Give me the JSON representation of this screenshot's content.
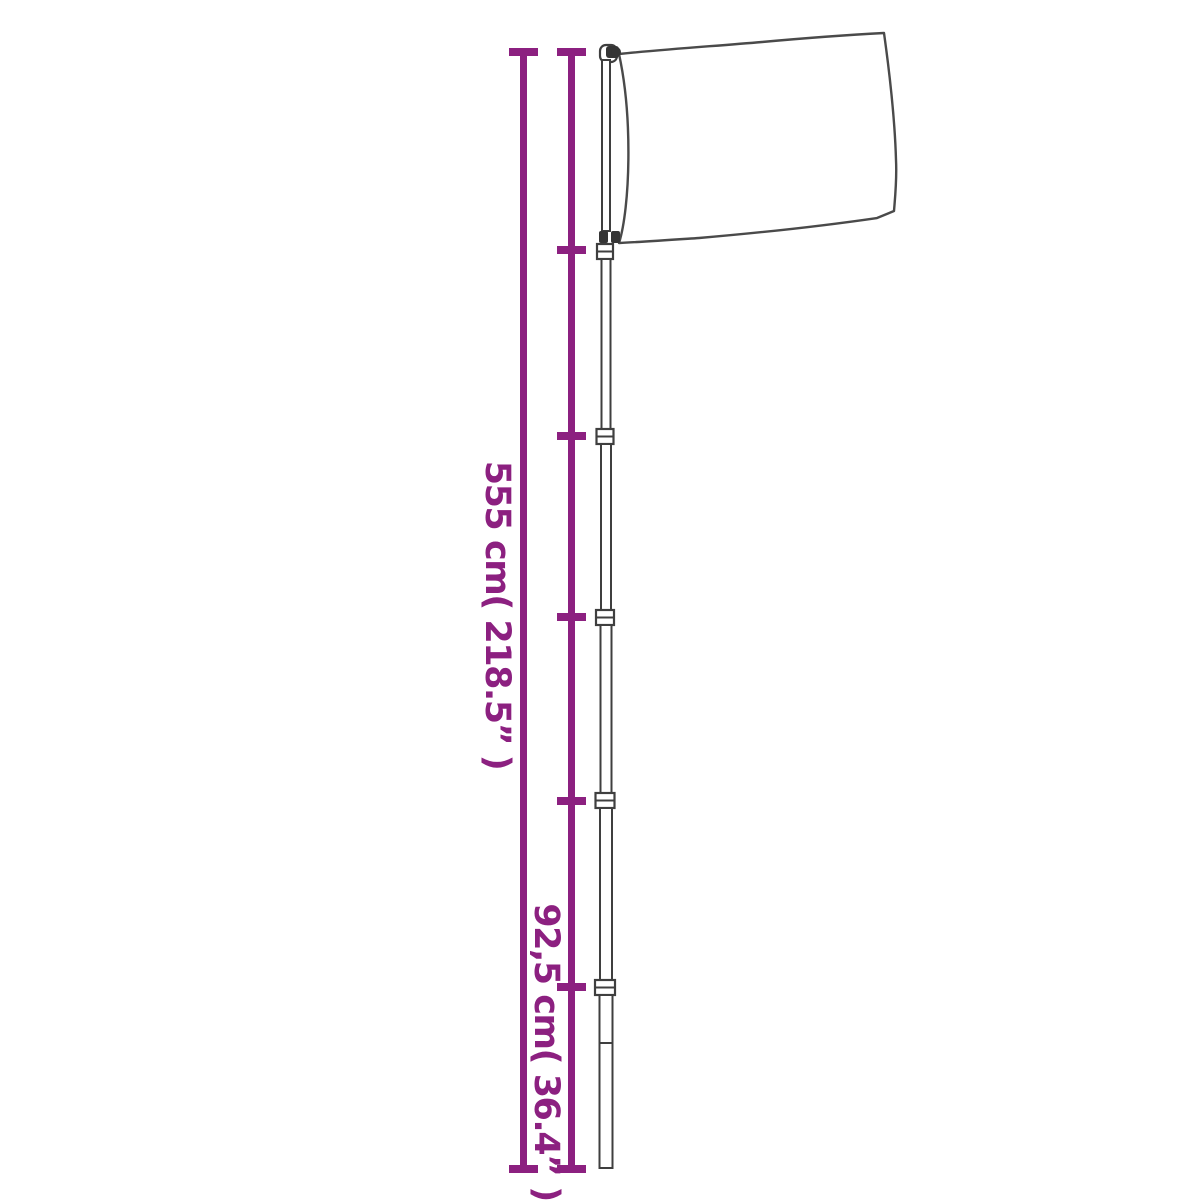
{
  "colors": {
    "accent": "#8C2080",
    "drawing": "#3F3F3F",
    "flag_outline": "#4A4A4A",
    "background": "#FFFFFF"
  },
  "diagram": {
    "kind": "telescopic flagpole with flag - dimension drawing",
    "labels": {
      "total_height": "555 cm( 218.5” )",
      "section_height": "92,5 cm( 36.4” )"
    },
    "measurements": {
      "total_height_cm": 555,
      "total_height_in": 218.5,
      "section_height_cm": 92.5,
      "section_height_in": 36.4,
      "visible_pole_sections": 6
    }
  }
}
